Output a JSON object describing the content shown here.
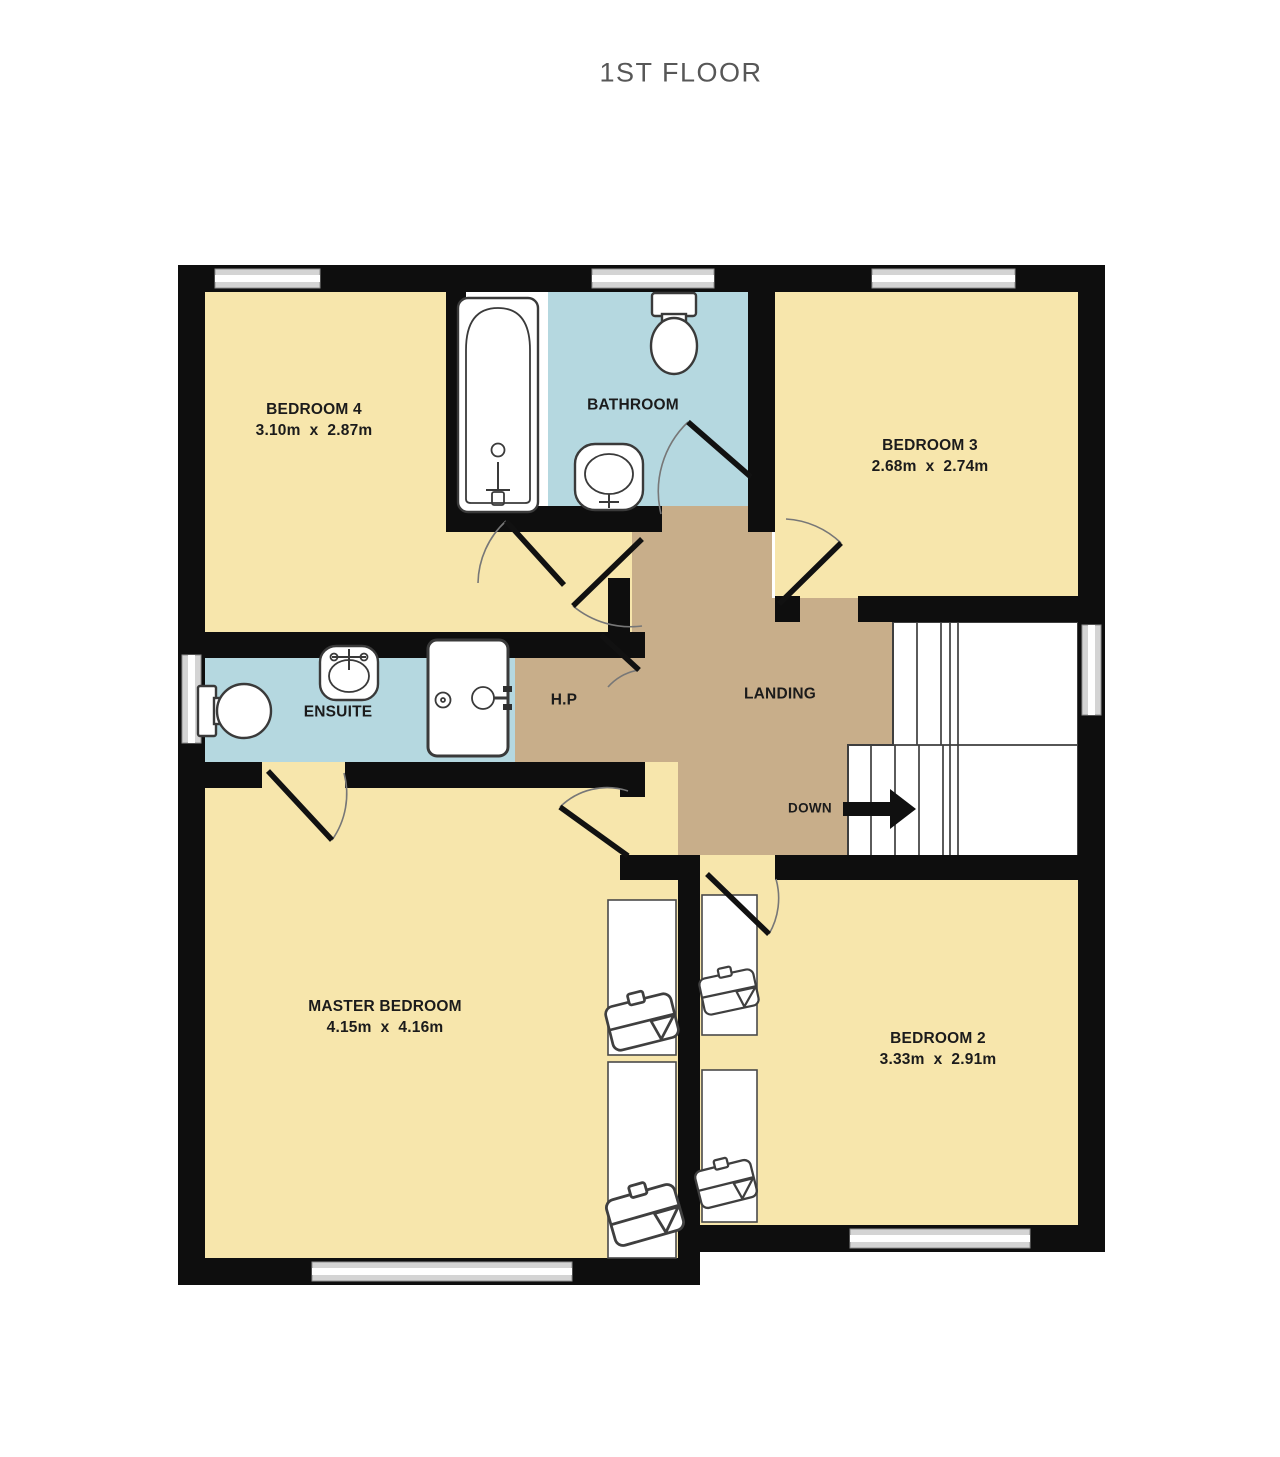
{
  "title": "1ST FLOOR",
  "colors": {
    "room": "#f7e6ac",
    "wet_room": "#b5d8e0",
    "landing": "#c8ae8a",
    "wall": "#0e0e0e",
    "window": "#d4d4d4"
  },
  "rooms": {
    "bedroom4": {
      "name": "BEDROOM 4",
      "dims": "3.10m  x  2.87m"
    },
    "bathroom": {
      "name": "BATHROOM"
    },
    "bedroom3": {
      "name": "BEDROOM 3",
      "dims": "2.68m  x  2.74m"
    },
    "ensuite": {
      "name": "ENSUITE"
    },
    "hot_press": {
      "name": "H.P"
    },
    "landing": {
      "name": "LANDING"
    },
    "master_bedroom": {
      "name": "MASTER BEDROOM",
      "dims": "4.15m  x  4.16m"
    },
    "bedroom2": {
      "name": "BEDROOM 2",
      "dims": "3.33m  x  2.91m"
    }
  },
  "stairs": {
    "down_label": "DOWN"
  }
}
